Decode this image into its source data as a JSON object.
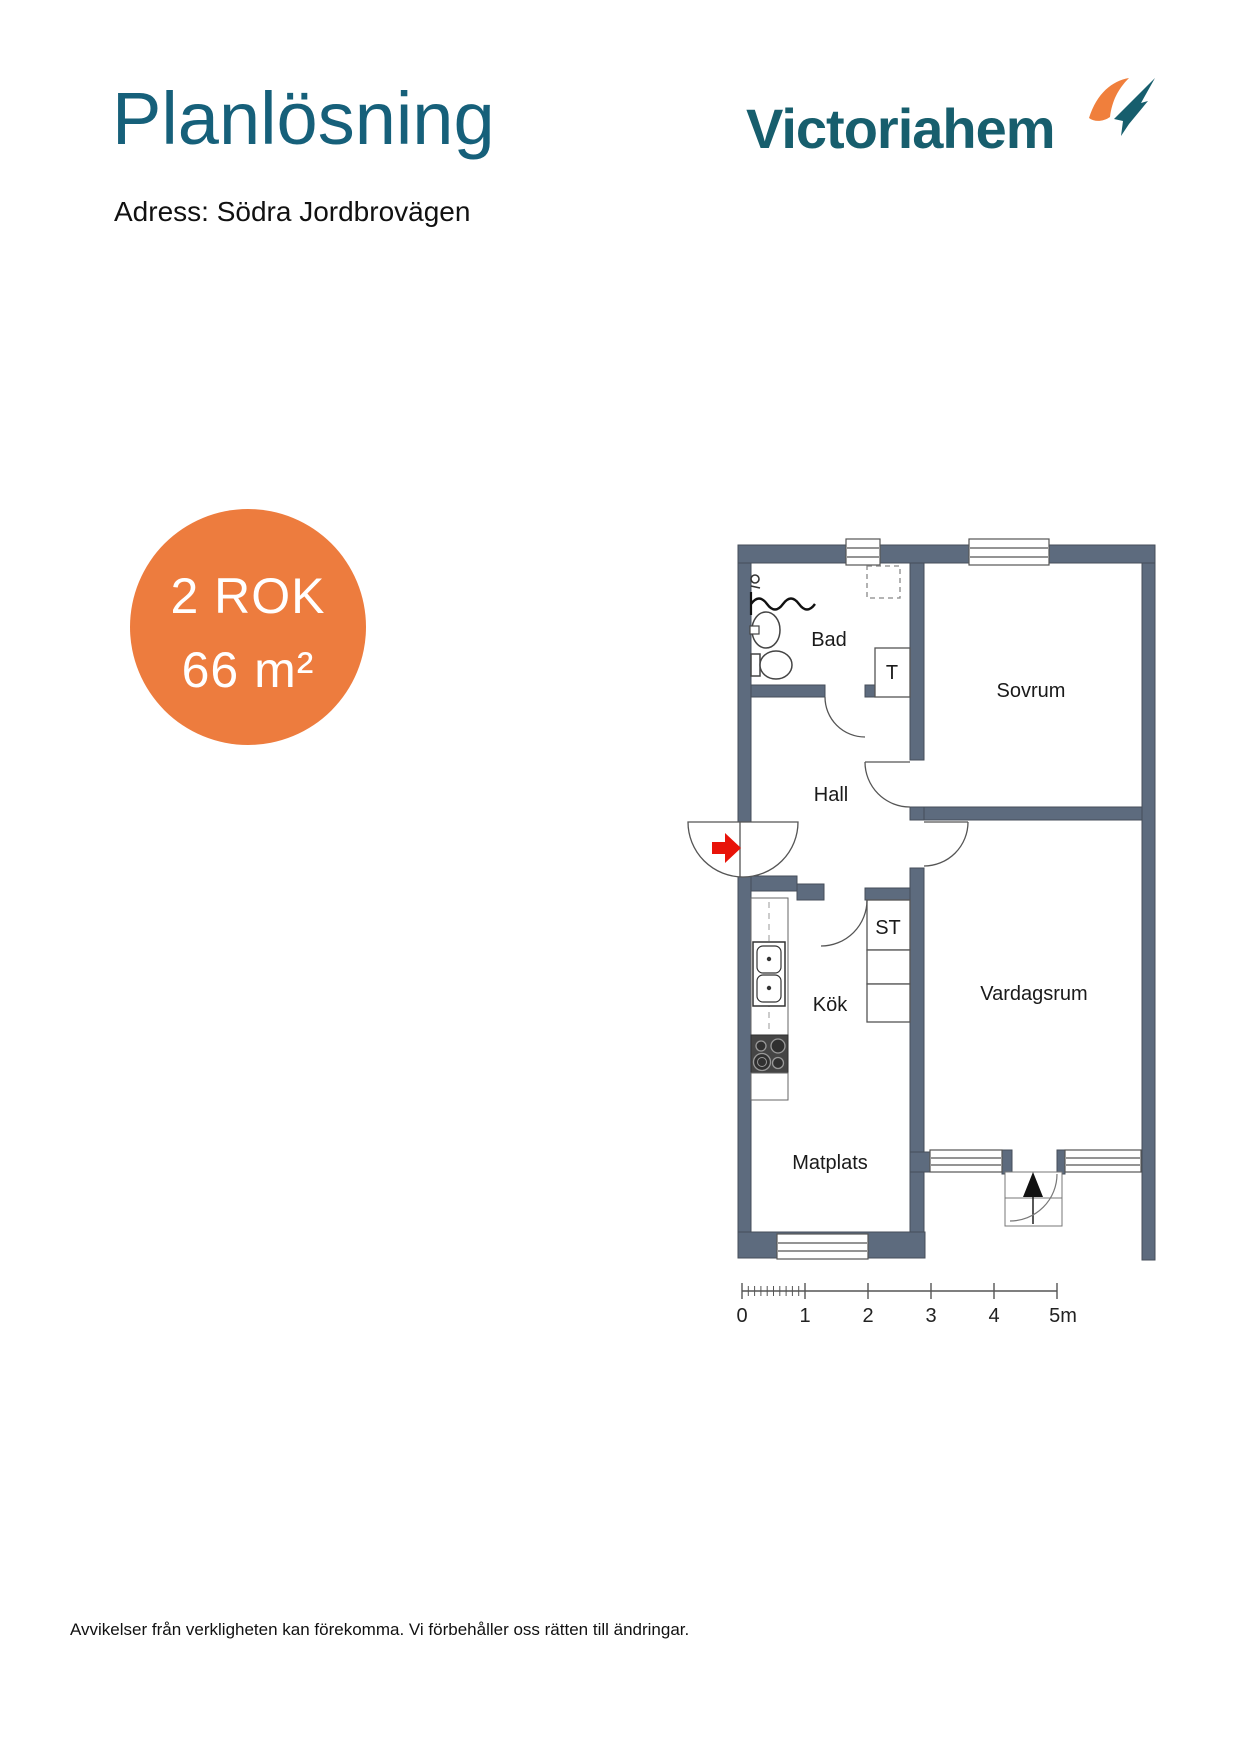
{
  "header": {
    "title": "Planlösning",
    "address": "Adress: Södra Jordbrovägen",
    "logo_text": "Victoriahem"
  },
  "badge": {
    "rooms": "2 ROK",
    "area": "66 m²"
  },
  "floorplan": {
    "rooms": {
      "bad": "Bad",
      "sovrum": "Sovrum",
      "hall": "Hall",
      "kok": "Kök",
      "vardagsrum": "Vardagsrum",
      "matplats": "Matplats",
      "t_closet": "T",
      "st_closet": "ST"
    },
    "scale": {
      "labels": [
        "0",
        "1",
        "2",
        "3",
        "4",
        "5m"
      ]
    }
  },
  "footer": {
    "disclaimer": "Avvikelser från verkligheten kan förekomma. Vi förbehåller oss rätten till ändringar."
  },
  "colors": {
    "teal_heading": "#16607a",
    "teal_logo": "#175e6d",
    "orange_badge": "#ED7C3E",
    "orange_mark": "#F07F3C",
    "wall": "#5d6b7e",
    "entrance_arrow_red": "#e81309"
  }
}
